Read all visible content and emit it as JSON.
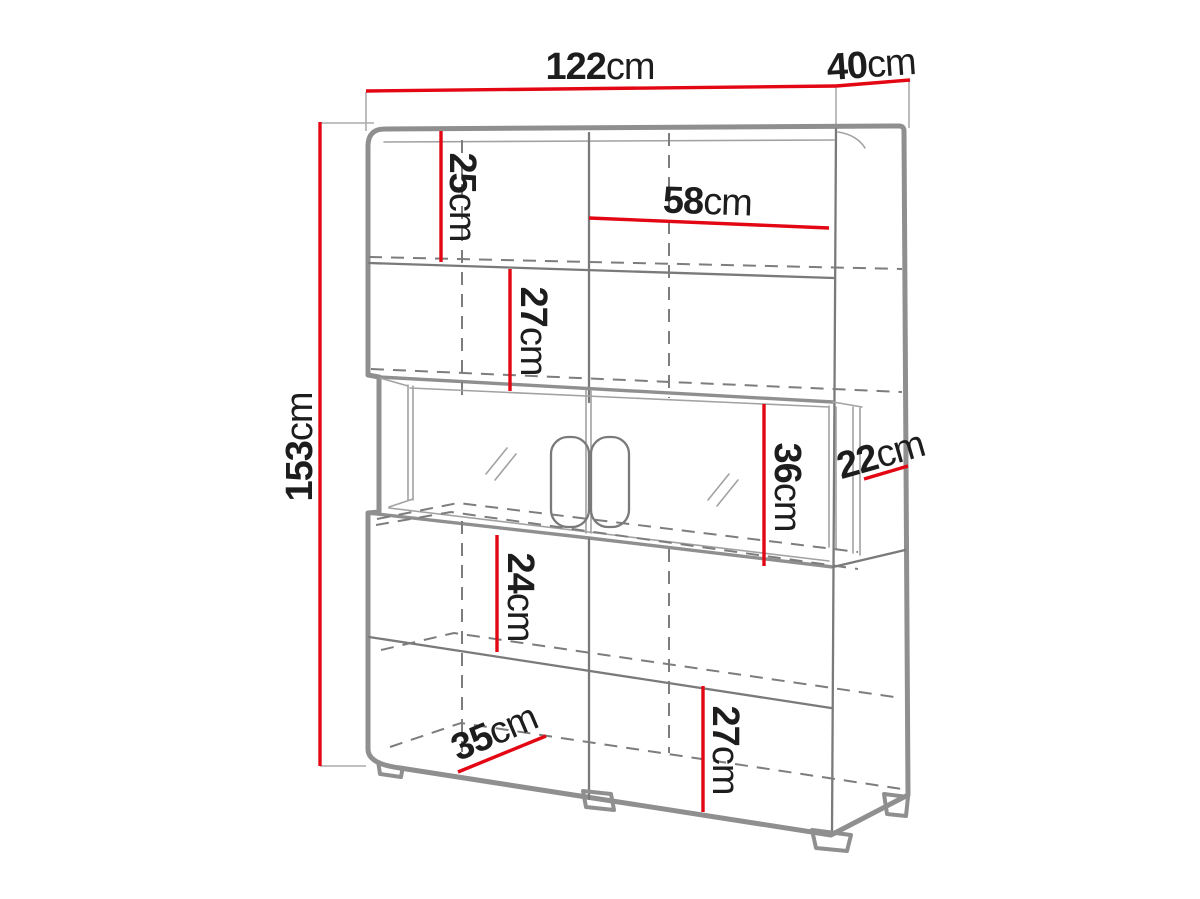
{
  "diagram": {
    "type": "furniture-dimension-drawing",
    "unit": "cm",
    "colors": {
      "dimension_line": "#e30613",
      "drawing_line": "#8f8f8f",
      "hidden_line": "#7d7d7d",
      "label_text": "#1d1d1d",
      "background": "#ffffff"
    },
    "dimensions": {
      "front_width": {
        "value": "122",
        "unit": "cm"
      },
      "top_depth": {
        "value": "40",
        "unit": "cm"
      },
      "total_height": {
        "value": "153",
        "unit": "cm"
      },
      "top_shelf": {
        "value": "25",
        "unit": "cm"
      },
      "inner_width": {
        "value": "58",
        "unit": "cm"
      },
      "upper_shelf": {
        "value": "27",
        "unit": "cm"
      },
      "niche_height": {
        "value": "36",
        "unit": "cm"
      },
      "niche_depth": {
        "value": "22",
        "unit": "cm"
      },
      "lower_shelf": {
        "value": "24",
        "unit": "cm"
      },
      "bottom_shelf": {
        "value": "27",
        "unit": "cm"
      },
      "bottom_depth": {
        "value": "35",
        "unit": "cm"
      }
    }
  }
}
